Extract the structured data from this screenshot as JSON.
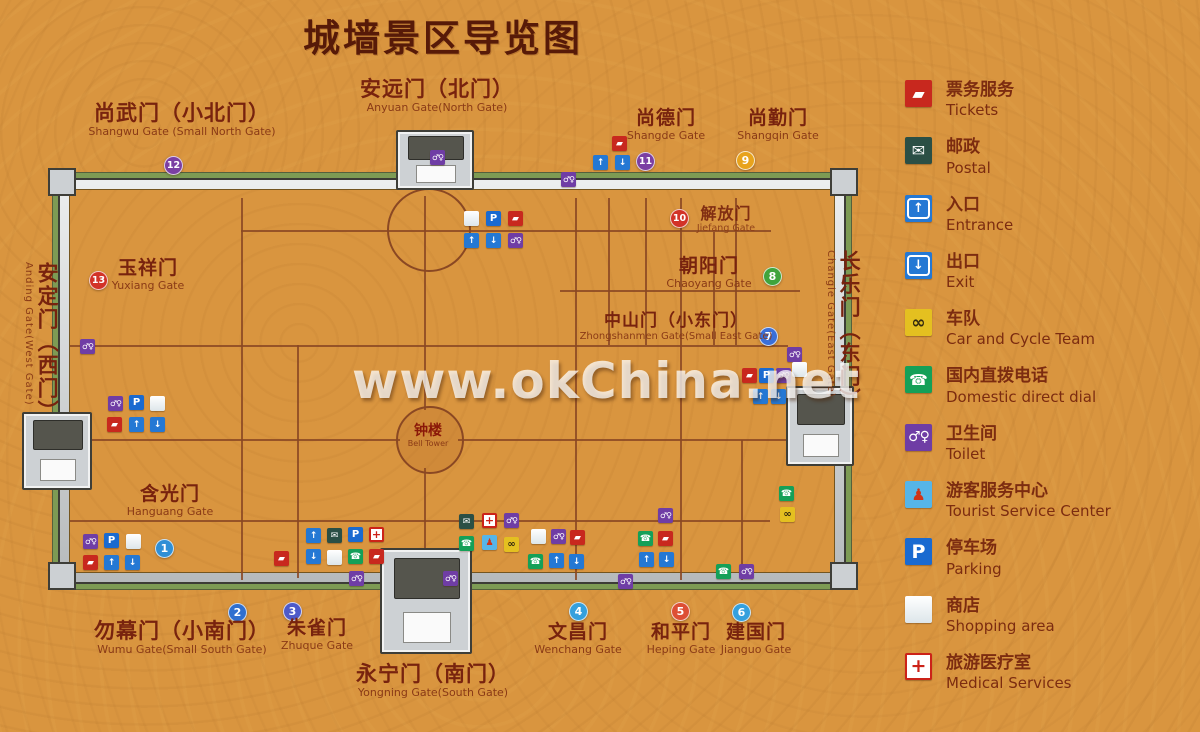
{
  "title": "城墙景区导览图",
  "watermark": "www.okChina.net",
  "bell_tower": {
    "cn": "钟楼",
    "en": "Bell Tower"
  },
  "colors": {
    "background": "#d9953f",
    "title_text": "#571a08",
    "label_text": "#78230e",
    "wall_gray": "#c6cacc",
    "moat_green": "#7d9b54",
    "road_brown": "#8a4823"
  },
  "gates": [
    {
      "id": "shangwu",
      "cn": "尚武门（小北门）",
      "en": "Shangwu Gate (Small North Gate)",
      "x": 182,
      "y": 102,
      "dir": "h",
      "s": "lg"
    },
    {
      "id": "anyuan",
      "cn": "安远门（北门）",
      "en": "Anyuan Gate(North Gate)",
      "x": 437,
      "y": 78,
      "dir": "h",
      "s": "lg"
    },
    {
      "id": "shangde",
      "cn": "尚德门",
      "en": "Shangde Gate",
      "x": 666,
      "y": 108,
      "dir": "h",
      "s": "md"
    },
    {
      "id": "shangqin",
      "cn": "尚勤门",
      "en": "Shangqin Gate",
      "x": 778,
      "y": 108,
      "dir": "h",
      "s": "md"
    },
    {
      "id": "jiefang",
      "cn": "解放门",
      "en": "Jiefang Gate",
      "x": 726,
      "y": 205,
      "dir": "h",
      "s": "sm"
    },
    {
      "id": "chaoyang",
      "cn": "朝阳门",
      "en": "Chaoyang Gate",
      "x": 709,
      "y": 256,
      "dir": "h",
      "s": "md"
    },
    {
      "id": "zhongshan",
      "cn": "中山门（小东门）",
      "en": "Zhongshanmen Gate(Small East Gate)",
      "x": 676,
      "y": 312,
      "dir": "h",
      "s": "sm2"
    },
    {
      "id": "yuxiang",
      "cn": "玉祥门",
      "en": "Yuxiang Gate",
      "x": 148,
      "y": 258,
      "dir": "h",
      "s": "md"
    },
    {
      "id": "hanguang",
      "cn": "含光门",
      "en": "Hanguang Gate",
      "x": 170,
      "y": 484,
      "dir": "h",
      "s": "md"
    },
    {
      "id": "wumu",
      "cn": "勿幕门（小南门）",
      "en": "Wumu Gate(Small South Gate)",
      "x": 182,
      "y": 620,
      "dir": "h",
      "s": "lg"
    },
    {
      "id": "zhuque",
      "cn": "朱雀门",
      "en": "Zhuque Gate",
      "x": 317,
      "y": 618,
      "dir": "h",
      "s": "md"
    },
    {
      "id": "yongning",
      "cn": "永宁门（南门）",
      "en": "Yongning Gate(South Gate)",
      "x": 433,
      "y": 663,
      "dir": "h",
      "s": "lg"
    },
    {
      "id": "wenchang",
      "cn": "文昌门",
      "en": "Wenchang Gate",
      "x": 578,
      "y": 622,
      "dir": "h",
      "s": "md"
    },
    {
      "id": "heping",
      "cn": "和平门",
      "en": "Heping Gate",
      "x": 681,
      "y": 622,
      "dir": "h",
      "s": "md"
    },
    {
      "id": "jianguo",
      "cn": "建国门",
      "en": "Jianguo Gate",
      "x": 756,
      "y": 622,
      "dir": "h",
      "s": "md"
    },
    {
      "id": "anding",
      "cn": "安定门（西门）",
      "en": "Anding Gate(West Gate)",
      "x": 22,
      "y": 262,
      "dir": "v",
      "s": "lg"
    },
    {
      "id": "changle",
      "cn": "长乐门（东门）",
      "en": "Changle Gate(East Gate)",
      "x": 824,
      "y": 250,
      "dir": "v",
      "s": "lg"
    }
  ],
  "markers": [
    {
      "n": "1",
      "x": 164,
      "y": 548,
      "c": "#2f8fd6"
    },
    {
      "n": "2",
      "x": 237,
      "y": 612,
      "c": "#2f6fcf"
    },
    {
      "n": "3",
      "x": 292,
      "y": 611,
      "c": "#4d5ac9"
    },
    {
      "n": "4",
      "x": 578,
      "y": 611,
      "c": "#35a0dd"
    },
    {
      "n": "5",
      "x": 680,
      "y": 611,
      "c": "#dd4f35"
    },
    {
      "n": "6",
      "x": 741,
      "y": 612,
      "c": "#35a0dd"
    },
    {
      "n": "7",
      "x": 768,
      "y": 336,
      "c": "#3a6fd8"
    },
    {
      "n": "8",
      "x": 772,
      "y": 276,
      "c": "#3fa43c"
    },
    {
      "n": "9",
      "x": 745,
      "y": 160,
      "c": "#e8a31c"
    },
    {
      "n": "10",
      "x": 679,
      "y": 218,
      "c": "#d23328"
    },
    {
      "n": "11",
      "x": 645,
      "y": 161,
      "c": "#7b3fa3"
    },
    {
      "n": "12",
      "x": 173,
      "y": 165,
      "c": "#7b3fa3"
    },
    {
      "n": "13",
      "x": 98,
      "y": 280,
      "c": "#d23328"
    }
  ],
  "map_icons": [
    {
      "t": "shop",
      "x": 464,
      "y": 211
    },
    {
      "t": "parking",
      "x": 486,
      "y": 211
    },
    {
      "t": "tickets",
      "x": 508,
      "y": 211
    },
    {
      "t": "entrance",
      "x": 464,
      "y": 233
    },
    {
      "t": "exit",
      "x": 486,
      "y": 233
    },
    {
      "t": "toilet",
      "x": 508,
      "y": 233
    },
    {
      "t": "toilet",
      "x": 430,
      "y": 150
    },
    {
      "t": "toilet",
      "x": 561,
      "y": 172
    },
    {
      "t": "tickets",
      "x": 612,
      "y": 136
    },
    {
      "t": "entrance",
      "x": 593,
      "y": 155
    },
    {
      "t": "exit",
      "x": 615,
      "y": 155
    },
    {
      "t": "toilet",
      "x": 80,
      "y": 339
    },
    {
      "t": "toilet",
      "x": 108,
      "y": 396
    },
    {
      "t": "parking",
      "x": 129,
      "y": 395
    },
    {
      "t": "shop",
      "x": 150,
      "y": 396
    },
    {
      "t": "tickets",
      "x": 107,
      "y": 417
    },
    {
      "t": "entrance",
      "x": 129,
      "y": 417
    },
    {
      "t": "exit",
      "x": 150,
      "y": 417
    },
    {
      "t": "toilet",
      "x": 83,
      "y": 534
    },
    {
      "t": "parking",
      "x": 104,
      "y": 533
    },
    {
      "t": "shop",
      "x": 126,
      "y": 534
    },
    {
      "t": "tickets",
      "x": 83,
      "y": 555
    },
    {
      "t": "entrance",
      "x": 104,
      "y": 555
    },
    {
      "t": "exit",
      "x": 125,
      "y": 555
    },
    {
      "t": "tickets",
      "x": 274,
      "y": 551
    },
    {
      "t": "entrance",
      "x": 306,
      "y": 528
    },
    {
      "t": "postal",
      "x": 327,
      "y": 528
    },
    {
      "t": "parking",
      "x": 348,
      "y": 527
    },
    {
      "t": "medical",
      "x": 369,
      "y": 527
    },
    {
      "t": "exit",
      "x": 306,
      "y": 549
    },
    {
      "t": "shop",
      "x": 327,
      "y": 550
    },
    {
      "t": "phone",
      "x": 348,
      "y": 549
    },
    {
      "t": "tickets",
      "x": 369,
      "y": 549
    },
    {
      "t": "toilet",
      "x": 349,
      "y": 571
    },
    {
      "t": "toilet",
      "x": 443,
      "y": 571
    },
    {
      "t": "postal",
      "x": 459,
      "y": 514
    },
    {
      "t": "medical",
      "x": 482,
      "y": 513
    },
    {
      "t": "toilet",
      "x": 504,
      "y": 513
    },
    {
      "t": "phone",
      "x": 459,
      "y": 536
    },
    {
      "t": "tourist",
      "x": 482,
      "y": 535
    },
    {
      "t": "cycle",
      "x": 504,
      "y": 537
    },
    {
      "t": "shop",
      "x": 531,
      "y": 529
    },
    {
      "t": "toilet",
      "x": 551,
      "y": 529
    },
    {
      "t": "tickets",
      "x": 570,
      "y": 530
    },
    {
      "t": "phone",
      "x": 528,
      "y": 554
    },
    {
      "t": "entrance",
      "x": 549,
      "y": 553
    },
    {
      "t": "exit",
      "x": 569,
      "y": 554
    },
    {
      "t": "toilet",
      "x": 618,
      "y": 574
    },
    {
      "t": "toilet",
      "x": 658,
      "y": 508
    },
    {
      "t": "phone",
      "x": 638,
      "y": 531
    },
    {
      "t": "tickets",
      "x": 658,
      "y": 531
    },
    {
      "t": "entrance",
      "x": 639,
      "y": 552
    },
    {
      "t": "exit",
      "x": 659,
      "y": 552
    },
    {
      "t": "phone",
      "x": 716,
      "y": 564
    },
    {
      "t": "toilet",
      "x": 739,
      "y": 564
    },
    {
      "t": "toilet",
      "x": 787,
      "y": 347
    },
    {
      "t": "tickets",
      "x": 742,
      "y": 368
    },
    {
      "t": "parking",
      "x": 759,
      "y": 368
    },
    {
      "t": "toilet",
      "x": 776,
      "y": 368
    },
    {
      "t": "shop",
      "x": 792,
      "y": 362
    },
    {
      "t": "entrance",
      "x": 753,
      "y": 389
    },
    {
      "t": "exit",
      "x": 771,
      "y": 389
    },
    {
      "t": "phone",
      "x": 779,
      "y": 486
    },
    {
      "t": "cycle",
      "x": 780,
      "y": 507
    }
  ],
  "legend": [
    {
      "type": "tickets",
      "cn": "票务服务",
      "en": "Tickets"
    },
    {
      "type": "postal",
      "cn": "邮政",
      "en": "Postal"
    },
    {
      "type": "entrance",
      "cn": "入口",
      "en": "Entrance"
    },
    {
      "type": "exit",
      "cn": "出口",
      "en": "Exit"
    },
    {
      "type": "cycle",
      "cn": "车队",
      "en": "Car and Cycle Team"
    },
    {
      "type": "phone",
      "cn": "国内直拨电话",
      "en": "Domestic direct dial"
    },
    {
      "type": "toilet",
      "cn": "卫生间",
      "en": "Toilet"
    },
    {
      "type": "tourist",
      "cn": "游客服务中心",
      "en": "Tourist Service Center"
    },
    {
      "type": "parking",
      "cn": "停车场",
      "en": "Parking"
    },
    {
      "type": "shop",
      "cn": "商店",
      "en": "Shopping area"
    },
    {
      "type": "medical",
      "cn": "旅游医疗室",
      "en": "Medical Services"
    }
  ]
}
